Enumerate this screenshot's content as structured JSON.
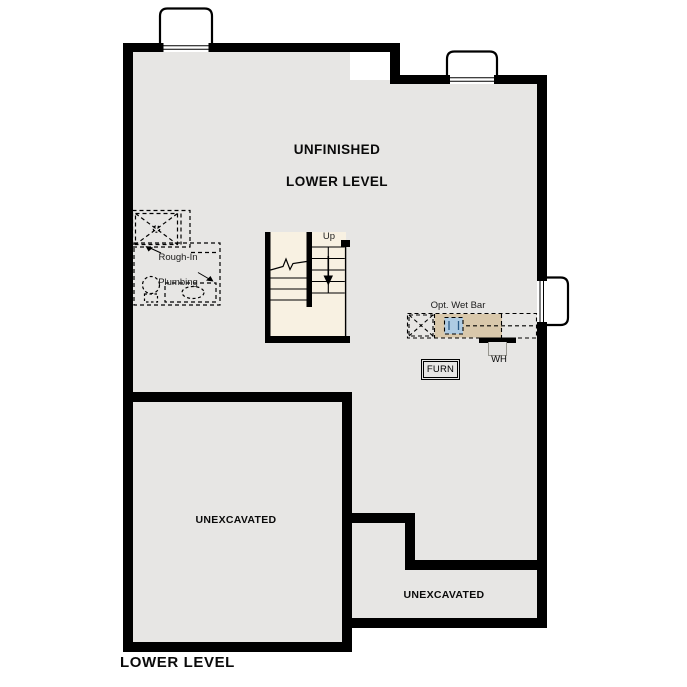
{
  "plan": {
    "title": "LOWER LEVEL",
    "room_title_line1": "UNFINISHED",
    "room_title_line2": "LOWER LEVEL"
  },
  "labels": {
    "stairs_up": "Up",
    "plumbing_line1": "Rough-In",
    "plumbing_line2": "Plumbing",
    "wet_bar": "Opt. Wet Bar",
    "water_heater": "WH",
    "furnace": "FURN",
    "unexcavated_left": "UNEXCAVATED",
    "unexcavated_right": "UNEXCAVATED"
  },
  "colors": {
    "floor": "#e7e6e4",
    "wall": "#000000",
    "stair_fill": "#f8f1e2",
    "counter_tan": "#d9c8ab",
    "sink_blue": "#aecbe3",
    "well_fill": "#ffffff"
  }
}
